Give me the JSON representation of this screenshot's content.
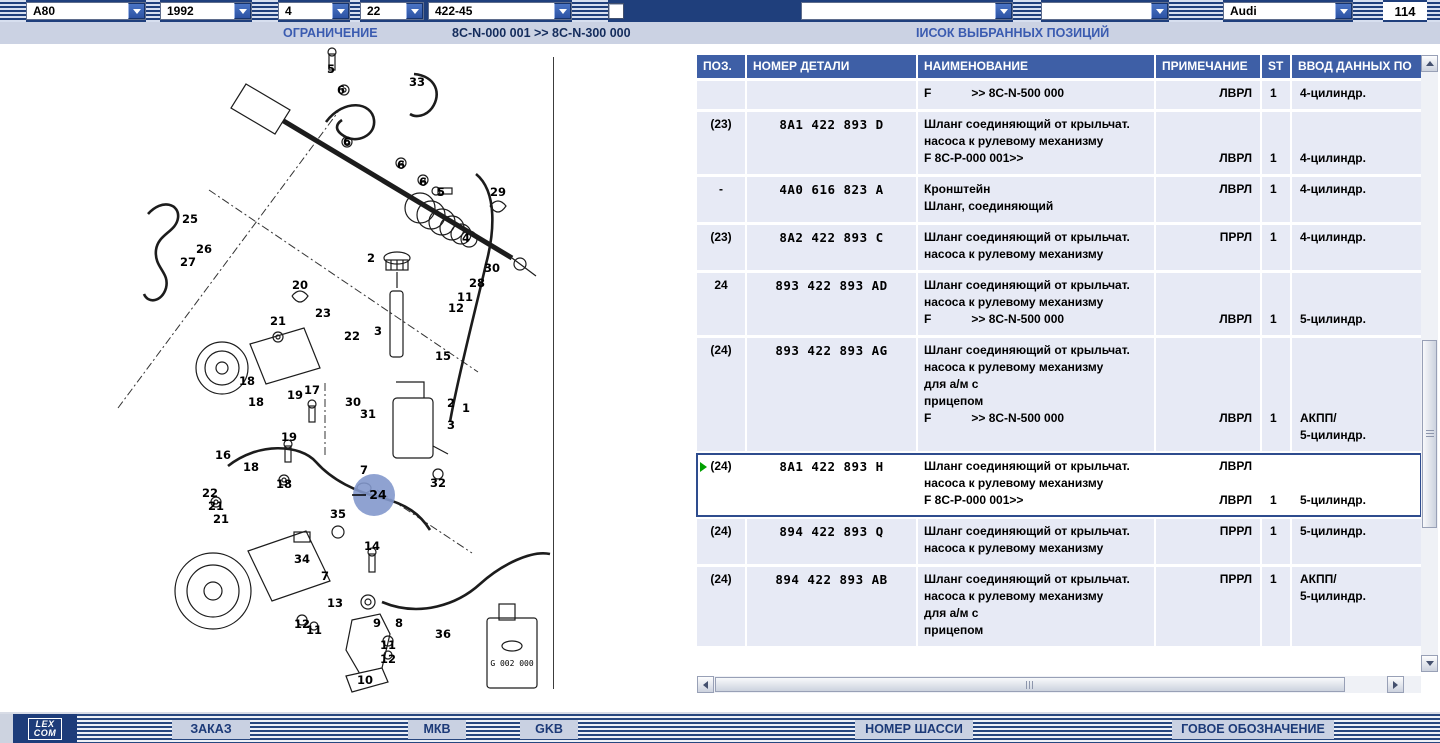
{
  "toolbar_top": {
    "dropdowns": [
      {
        "value": "A80"
      },
      {
        "value": "1992"
      },
      {
        "value": "4"
      },
      {
        "value": "22"
      },
      {
        "value": "422-45"
      },
      {
        "value": ""
      },
      {
        "value": ""
      },
      {
        "value": "Audi"
      }
    ],
    "page_number": "114"
  },
  "subheader": {
    "restriction_label": "ОГРАНИЧЕНИЕ",
    "range": "8C-N-000 001 >> 8C-N-300 000",
    "selected_positions_label": "IИСОК ВЫБРАННЫХ ПОЗИЦИЙ"
  },
  "table": {
    "headers": {
      "pos": "ПОЗ.",
      "part": "НОМЕР ДЕТАЛИ",
      "name": "НАИМЕНОВАНИЕ",
      "note": "ПРИМЕЧАНИЕ",
      "st": "ST",
      "extra": "ВВОД ДАННЫХ ПО"
    },
    "rows": [
      {
        "pos": "",
        "part": "",
        "selected": false,
        "name": [
          "F            >> 8C-N-500 000"
        ],
        "note": [
          "ЛВРЛ"
        ],
        "st": [
          "1"
        ],
        "extra": [
          "4-цилиндр."
        ]
      },
      {
        "pos": "(23)",
        "part": "8A1 422 893 D",
        "selected": false,
        "name": [
          "Шланг соединяющий от крыльчат.",
          "насоса к рулевому механизму",
          "F 8C-P-000 001>>"
        ],
        "note": [
          "",
          "",
          "ЛВРЛ"
        ],
        "st": [
          "",
          "",
          "1"
        ],
        "extra": [
          "",
          "",
          "4-цилиндр."
        ]
      },
      {
        "pos": "-",
        "part": "4A0 616 823 A",
        "selected": false,
        "name": [
          "Кронштейн",
          "Шланг, соединяющий"
        ],
        "note": [
          "ЛВРЛ"
        ],
        "st": [
          "1"
        ],
        "extra": [
          "4-цилиндр."
        ]
      },
      {
        "pos": "(23)",
        "part": "8A2 422 893 C",
        "selected": false,
        "name": [
          "Шланг соединяющий от крыльчат.",
          "насоса к рулевому механизму"
        ],
        "note": [
          "ПРРЛ"
        ],
        "st": [
          "1"
        ],
        "extra": [
          "4-цилиндр."
        ]
      },
      {
        "pos": "24",
        "part": "893 422 893 AD",
        "selected": false,
        "name": [
          "Шланг соединяющий от крыльчат.",
          "насоса к рулевому механизму",
          "F            >> 8C-N-500 000"
        ],
        "note": [
          "",
          "",
          "ЛВРЛ"
        ],
        "st": [
          "",
          "",
          "1"
        ],
        "extra": [
          "",
          "",
          "5-цилиндр."
        ]
      },
      {
        "pos": "(24)",
        "part": "893 422 893 AG",
        "selected": false,
        "name": [
          "Шланг соединяющий от крыльчат.",
          "насоса к рулевому механизму",
          "для а/м с",
          "прицепом",
          "F            >> 8C-N-500 000"
        ],
        "note": [
          "",
          "",
          "",
          "",
          "ЛВРЛ"
        ],
        "st": [
          "",
          "",
          "",
          "",
          "1"
        ],
        "extra": [
          "",
          "",
          "",
          "",
          "АКПП/",
          "5-цилиндр."
        ]
      },
      {
        "pos": "(24)",
        "part": "8A1 422 893 H",
        "selected": true,
        "name": [
          "Шланг соединяющий от крыльчат.",
          "насоса к рулевому механизму",
          "F 8C-P-000 001>>"
        ],
        "note": [
          "ЛВРЛ",
          "",
          "ЛВРЛ"
        ],
        "st": [
          "",
          "",
          "1"
        ],
        "extra": [
          "",
          "",
          "5-цилиндр."
        ]
      },
      {
        "pos": "(24)",
        "part": "894 422 893 Q",
        "selected": false,
        "name": [
          "Шланг соединяющий от крыльчат.",
          "насоса к рулевому механизму"
        ],
        "note": [
          "ПРРЛ"
        ],
        "st": [
          "1"
        ],
        "extra": [
          "5-цилиндр."
        ]
      },
      {
        "pos": "(24)",
        "part": "894 422 893 AB",
        "selected": false,
        "name": [
          "Шланг соединяющий от крыльчат.",
          "насоса к рулевому механизму",
          "для а/м с",
          "прицепом"
        ],
        "note": [
          "ПРРЛ"
        ],
        "st": [
          "1"
        ],
        "extra": [
          "АКПП/",
          "5-цилиндр."
        ]
      }
    ]
  },
  "diagram": {
    "highlight": "24",
    "bottle_label": "G 002 000",
    "callouts": [
      {
        "n": "5",
        "x": 331,
        "y": 27
      },
      {
        "n": "6",
        "x": 341,
        "y": 48
      },
      {
        "n": "33",
        "x": 417,
        "y": 40
      },
      {
        "n": "6",
        "x": 347,
        "y": 100
      },
      {
        "n": "6",
        "x": 401,
        "y": 123
      },
      {
        "n": "6",
        "x": 423,
        "y": 140
      },
      {
        "n": "5",
        "x": 441,
        "y": 150
      },
      {
        "n": "25",
        "x": 190,
        "y": 177
      },
      {
        "n": "29",
        "x": 498,
        "y": 150
      },
      {
        "n": "26",
        "x": 204,
        "y": 207
      },
      {
        "n": "27",
        "x": 188,
        "y": 220
      },
      {
        "n": "20",
        "x": 300,
        "y": 243
      },
      {
        "n": "2",
        "x": 371,
        "y": 216
      },
      {
        "n": "4",
        "x": 466,
        "y": 196
      },
      {
        "n": "30",
        "x": 492,
        "y": 226
      },
      {
        "n": "28",
        "x": 477,
        "y": 241
      },
      {
        "n": "11",
        "x": 465,
        "y": 255
      },
      {
        "n": "12",
        "x": 456,
        "y": 266
      },
      {
        "n": "23",
        "x": 323,
        "y": 271
      },
      {
        "n": "21",
        "x": 278,
        "y": 279
      },
      {
        "n": "22",
        "x": 352,
        "y": 294
      },
      {
        "n": "3",
        "x": 378,
        "y": 289
      },
      {
        "n": "15",
        "x": 443,
        "y": 314
      },
      {
        "n": "18",
        "x": 247,
        "y": 339
      },
      {
        "n": "17",
        "x": 312,
        "y": 348
      },
      {
        "n": "19",
        "x": 295,
        "y": 353
      },
      {
        "n": "30",
        "x": 353,
        "y": 360
      },
      {
        "n": "31",
        "x": 368,
        "y": 372
      },
      {
        "n": "2",
        "x": 451,
        "y": 361
      },
      {
        "n": "1",
        "x": 466,
        "y": 366
      },
      {
        "n": "3",
        "x": 451,
        "y": 383
      },
      {
        "n": "18",
        "x": 256,
        "y": 360
      },
      {
        "n": "19",
        "x": 289,
        "y": 395
      },
      {
        "n": "16",
        "x": 223,
        "y": 413
      },
      {
        "n": "18",
        "x": 251,
        "y": 425
      },
      {
        "n": "32",
        "x": 438,
        "y": 441
      },
      {
        "n": "18",
        "x": 284,
        "y": 442
      },
      {
        "n": "22",
        "x": 210,
        "y": 451
      },
      {
        "n": "21",
        "x": 216,
        "y": 464
      },
      {
        "n": "21",
        "x": 221,
        "y": 477
      },
      {
        "n": "35",
        "x": 338,
        "y": 472
      },
      {
        "n": "14",
        "x": 372,
        "y": 504
      },
      {
        "n": "34",
        "x": 302,
        "y": 517
      },
      {
        "n": "7",
        "x": 364,
        "y": 428
      },
      {
        "n": "7",
        "x": 325,
        "y": 534
      },
      {
        "n": "13",
        "x": 335,
        "y": 561
      },
      {
        "n": "9",
        "x": 377,
        "y": 581
      },
      {
        "n": "8",
        "x": 399,
        "y": 581
      },
      {
        "n": "12",
        "x": 302,
        "y": 582
      },
      {
        "n": "11",
        "x": 314,
        "y": 588
      },
      {
        "n": "11",
        "x": 388,
        "y": 603
      },
      {
        "n": "12",
        "x": 388,
        "y": 617
      },
      {
        "n": "10",
        "x": 365,
        "y": 638
      },
      {
        "n": "36",
        "x": 443,
        "y": 592
      }
    ]
  },
  "toolbar_bottom": {
    "logo_line1": "LEX",
    "logo_line2": "COM",
    "buttons": [
      "ЗАКАЗ",
      "МКВ",
      "GKB",
      "НОМЕР ШАССИ",
      "ГОВОЕ ОБОЗНАЧЕНИЕ"
    ]
  },
  "colors": {
    "toolbar_navy": "#1f3f7c",
    "table_header_blue": "#3e5fa6",
    "row_bg": "#e7eaf5",
    "subheader_bg": "#cbd2e3",
    "highlight_circle": "#8398cc",
    "selected_border": "#2e4c8e",
    "marker_green": "#00a000",
    "bottom_button_bg": "#c9d1e2"
  }
}
